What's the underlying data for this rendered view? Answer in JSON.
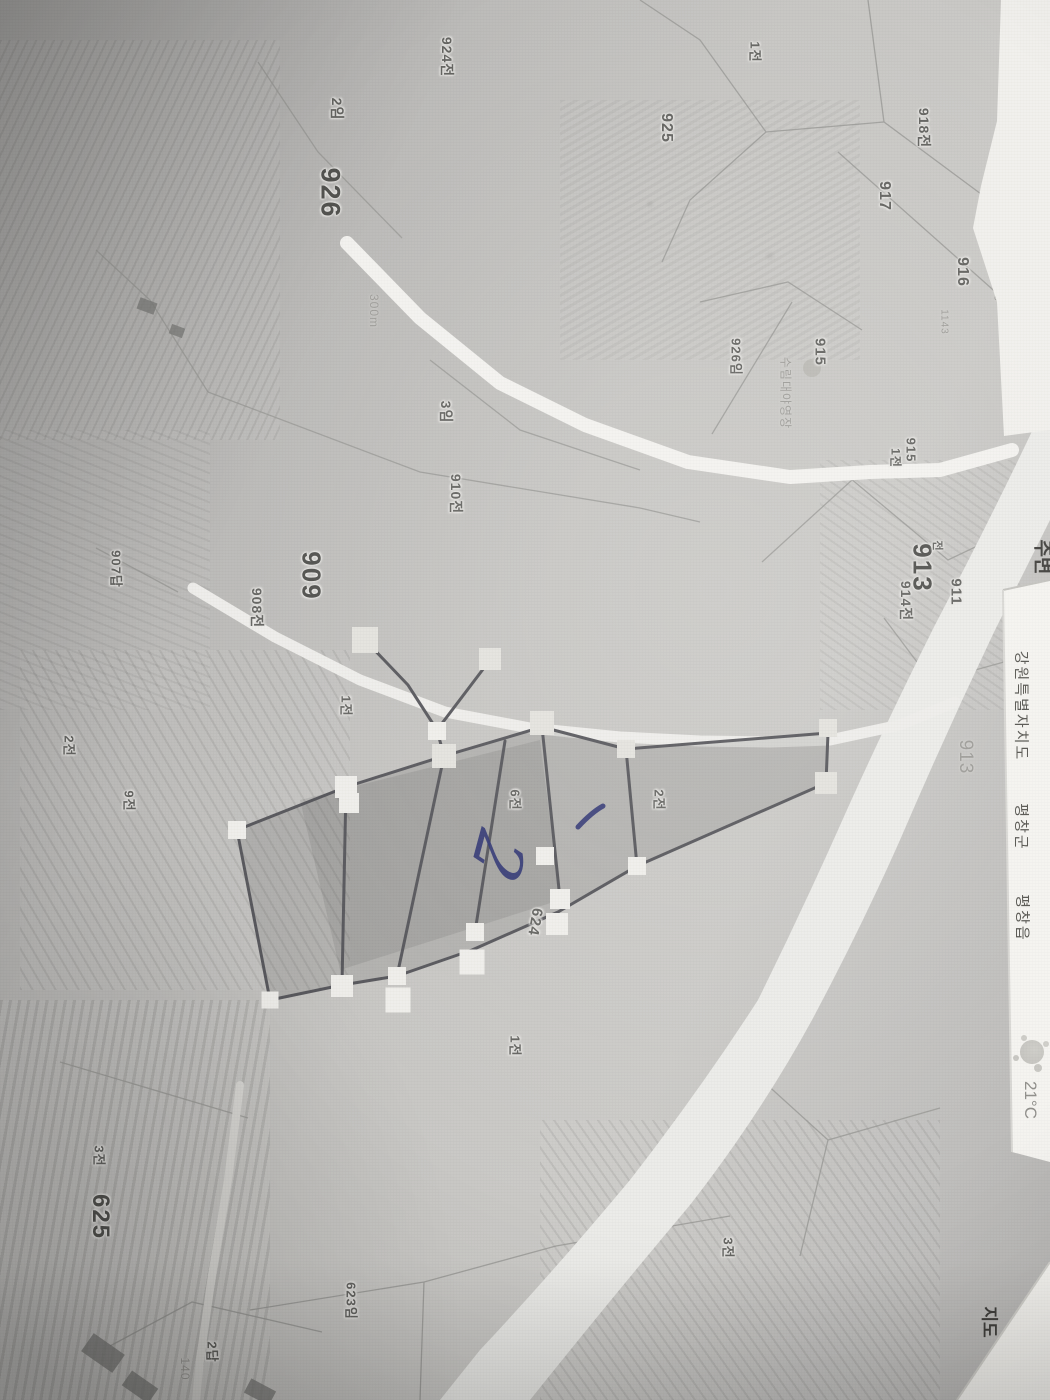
{
  "map": {
    "parcel_labels": [
      {
        "text": "924전",
        "x": 447,
        "y": 57,
        "size": 14
      },
      {
        "text": "1전",
        "x": 756,
        "y": 52,
        "size": 13
      },
      {
        "text": "925",
        "x": 666,
        "y": 128,
        "size": 16
      },
      {
        "text": "2임",
        "x": 337,
        "y": 109,
        "size": 14
      },
      {
        "text": "926",
        "x": 330,
        "y": 193,
        "size": 27,
        "bold": true
      },
      {
        "text": "918전",
        "x": 924,
        "y": 128,
        "size": 14
      },
      {
        "text": "917",
        "x": 884,
        "y": 196,
        "size": 16
      },
      {
        "text": "916",
        "x": 962,
        "y": 272,
        "size": 16
      },
      {
        "text": "1143",
        "x": 997,
        "y": 289,
        "size": 10,
        "faint": true
      },
      {
        "text": "1143",
        "x": 944,
        "y": 322,
        "size": 10,
        "faint": true
      },
      {
        "text": "926임",
        "x": 737,
        "y": 357,
        "size": 13
      },
      {
        "text": "915",
        "x": 820,
        "y": 352,
        "size": 15
      },
      {
        "text": "300m",
        "x": 374,
        "y": 311,
        "size": 12,
        "faint": true
      },
      {
        "text": "3임",
        "x": 446,
        "y": 412,
        "size": 14
      },
      {
        "text": "910전",
        "x": 456,
        "y": 494,
        "size": 14
      },
      {
        "text": "911",
        "x": 956,
        "y": 592,
        "size": 15
      },
      {
        "text": "915",
        "x": 911,
        "y": 450,
        "size": 13
      },
      {
        "text": "1전",
        "x": 896,
        "y": 458,
        "size": 12
      },
      {
        "text": "913",
        "x": 922,
        "y": 568,
        "size": 26,
        "bold": true
      },
      {
        "text": "전",
        "x": 938,
        "y": 546,
        "size": 11
      },
      {
        "text": "914전",
        "x": 906,
        "y": 601,
        "size": 14
      },
      {
        "text": "909",
        "x": 311,
        "y": 576,
        "size": 26,
        "bold": true
      },
      {
        "text": "908전",
        "x": 257,
        "y": 608,
        "size": 14
      },
      {
        "text": "907답",
        "x": 117,
        "y": 569,
        "size": 13
      },
      {
        "text": "1전",
        "x": 347,
        "y": 706,
        "size": 13
      },
      {
        "text": "2전",
        "x": 70,
        "y": 746,
        "size": 13
      },
      {
        "text": "9전",
        "x": 130,
        "y": 801,
        "size": 13
      },
      {
        "text": "6전",
        "x": 516,
        "y": 800,
        "size": 13
      },
      {
        "text": "2전",
        "x": 660,
        "y": 800,
        "size": 13
      },
      {
        "text": "913",
        "x": 965,
        "y": 757,
        "size": 19,
        "faint": true
      },
      {
        "text": "624",
        "x": 535,
        "y": 922,
        "size": 15,
        "rot": 100
      },
      {
        "text": "1전",
        "x": 516,
        "y": 1046,
        "size": 13
      },
      {
        "text": "3전",
        "x": 729,
        "y": 1248,
        "size": 13
      },
      {
        "text": "3전",
        "x": 100,
        "y": 1156,
        "size": 13
      },
      {
        "text": "625",
        "x": 100,
        "y": 1217,
        "size": 24,
        "bold": true
      },
      {
        "text": "623임",
        "x": 352,
        "y": 1301,
        "size": 13
      },
      {
        "text": "2답",
        "x": 213,
        "y": 1352,
        "size": 13
      },
      {
        "text": "140",
        "x": 185,
        "y": 1369,
        "size": 12,
        "faint": true
      },
      {
        "text": "수림대야영장",
        "x": 786,
        "y": 393,
        "size": 12,
        "faint": true
      }
    ],
    "handles": [
      {
        "x": 365,
        "y": 640,
        "s": 26,
        "tone": "light"
      },
      {
        "x": 490,
        "y": 659,
        "s": 22,
        "tone": "light"
      },
      {
        "x": 542,
        "y": 723,
        "s": 24,
        "tone": "light"
      },
      {
        "x": 444,
        "y": 756,
        "s": 24,
        "tone": "light"
      },
      {
        "x": 626,
        "y": 749,
        "s": 18,
        "tone": "light"
      },
      {
        "x": 828,
        "y": 728,
        "s": 18,
        "tone": "light"
      },
      {
        "x": 826,
        "y": 783,
        "s": 22,
        "tone": "light"
      },
      {
        "x": 437,
        "y": 731,
        "s": 18,
        "tone": "white"
      },
      {
        "x": 346,
        "y": 787,
        "s": 22,
        "tone": "white"
      },
      {
        "x": 349,
        "y": 803,
        "s": 20,
        "tone": "white"
      },
      {
        "x": 237,
        "y": 830,
        "s": 18,
        "tone": "white"
      },
      {
        "x": 270,
        "y": 1000,
        "s": 17,
        "tone": "white"
      },
      {
        "x": 342,
        "y": 986,
        "s": 22,
        "tone": "white"
      },
      {
        "x": 397,
        "y": 976,
        "s": 18,
        "tone": "white"
      },
      {
        "x": 398,
        "y": 1000,
        "s": 25,
        "tone": "white"
      },
      {
        "x": 472,
        "y": 962,
        "s": 25,
        "tone": "white"
      },
      {
        "x": 475,
        "y": 932,
        "s": 18,
        "tone": "white"
      },
      {
        "x": 545,
        "y": 856,
        "s": 18,
        "tone": "white"
      },
      {
        "x": 560,
        "y": 899,
        "s": 20,
        "tone": "white"
      },
      {
        "x": 557,
        "y": 924,
        "s": 22,
        "tone": "white"
      },
      {
        "x": 637,
        "y": 866,
        "s": 18,
        "tone": "white"
      }
    ],
    "annotations": [
      {
        "text": "2",
        "x": 497,
        "y": 856,
        "size": 68,
        "rot": 105
      },
      {
        "text": "1",
        "x": 590,
        "y": 817,
        "size": 42,
        "rot": 118
      }
    ],
    "colors": {
      "ink": "#2f3472",
      "road": "#f2f1ee",
      "river": "#ebebe8",
      "boundary": "#8f8f8c",
      "annotation_line": "#55555a",
      "handle_white": "#efeeea",
      "handle_light": "#e3e2dd"
    }
  },
  "ui": {
    "nearby_label": "주변",
    "region": {
      "province": "강원특별자치도",
      "county": "평창군",
      "town": "평창읍"
    },
    "weather": {
      "temp": "21°C",
      "icon": "sun-icon"
    },
    "map_toggle": {
      "map": "지도",
      "skyview": "스카이뷰"
    }
  }
}
